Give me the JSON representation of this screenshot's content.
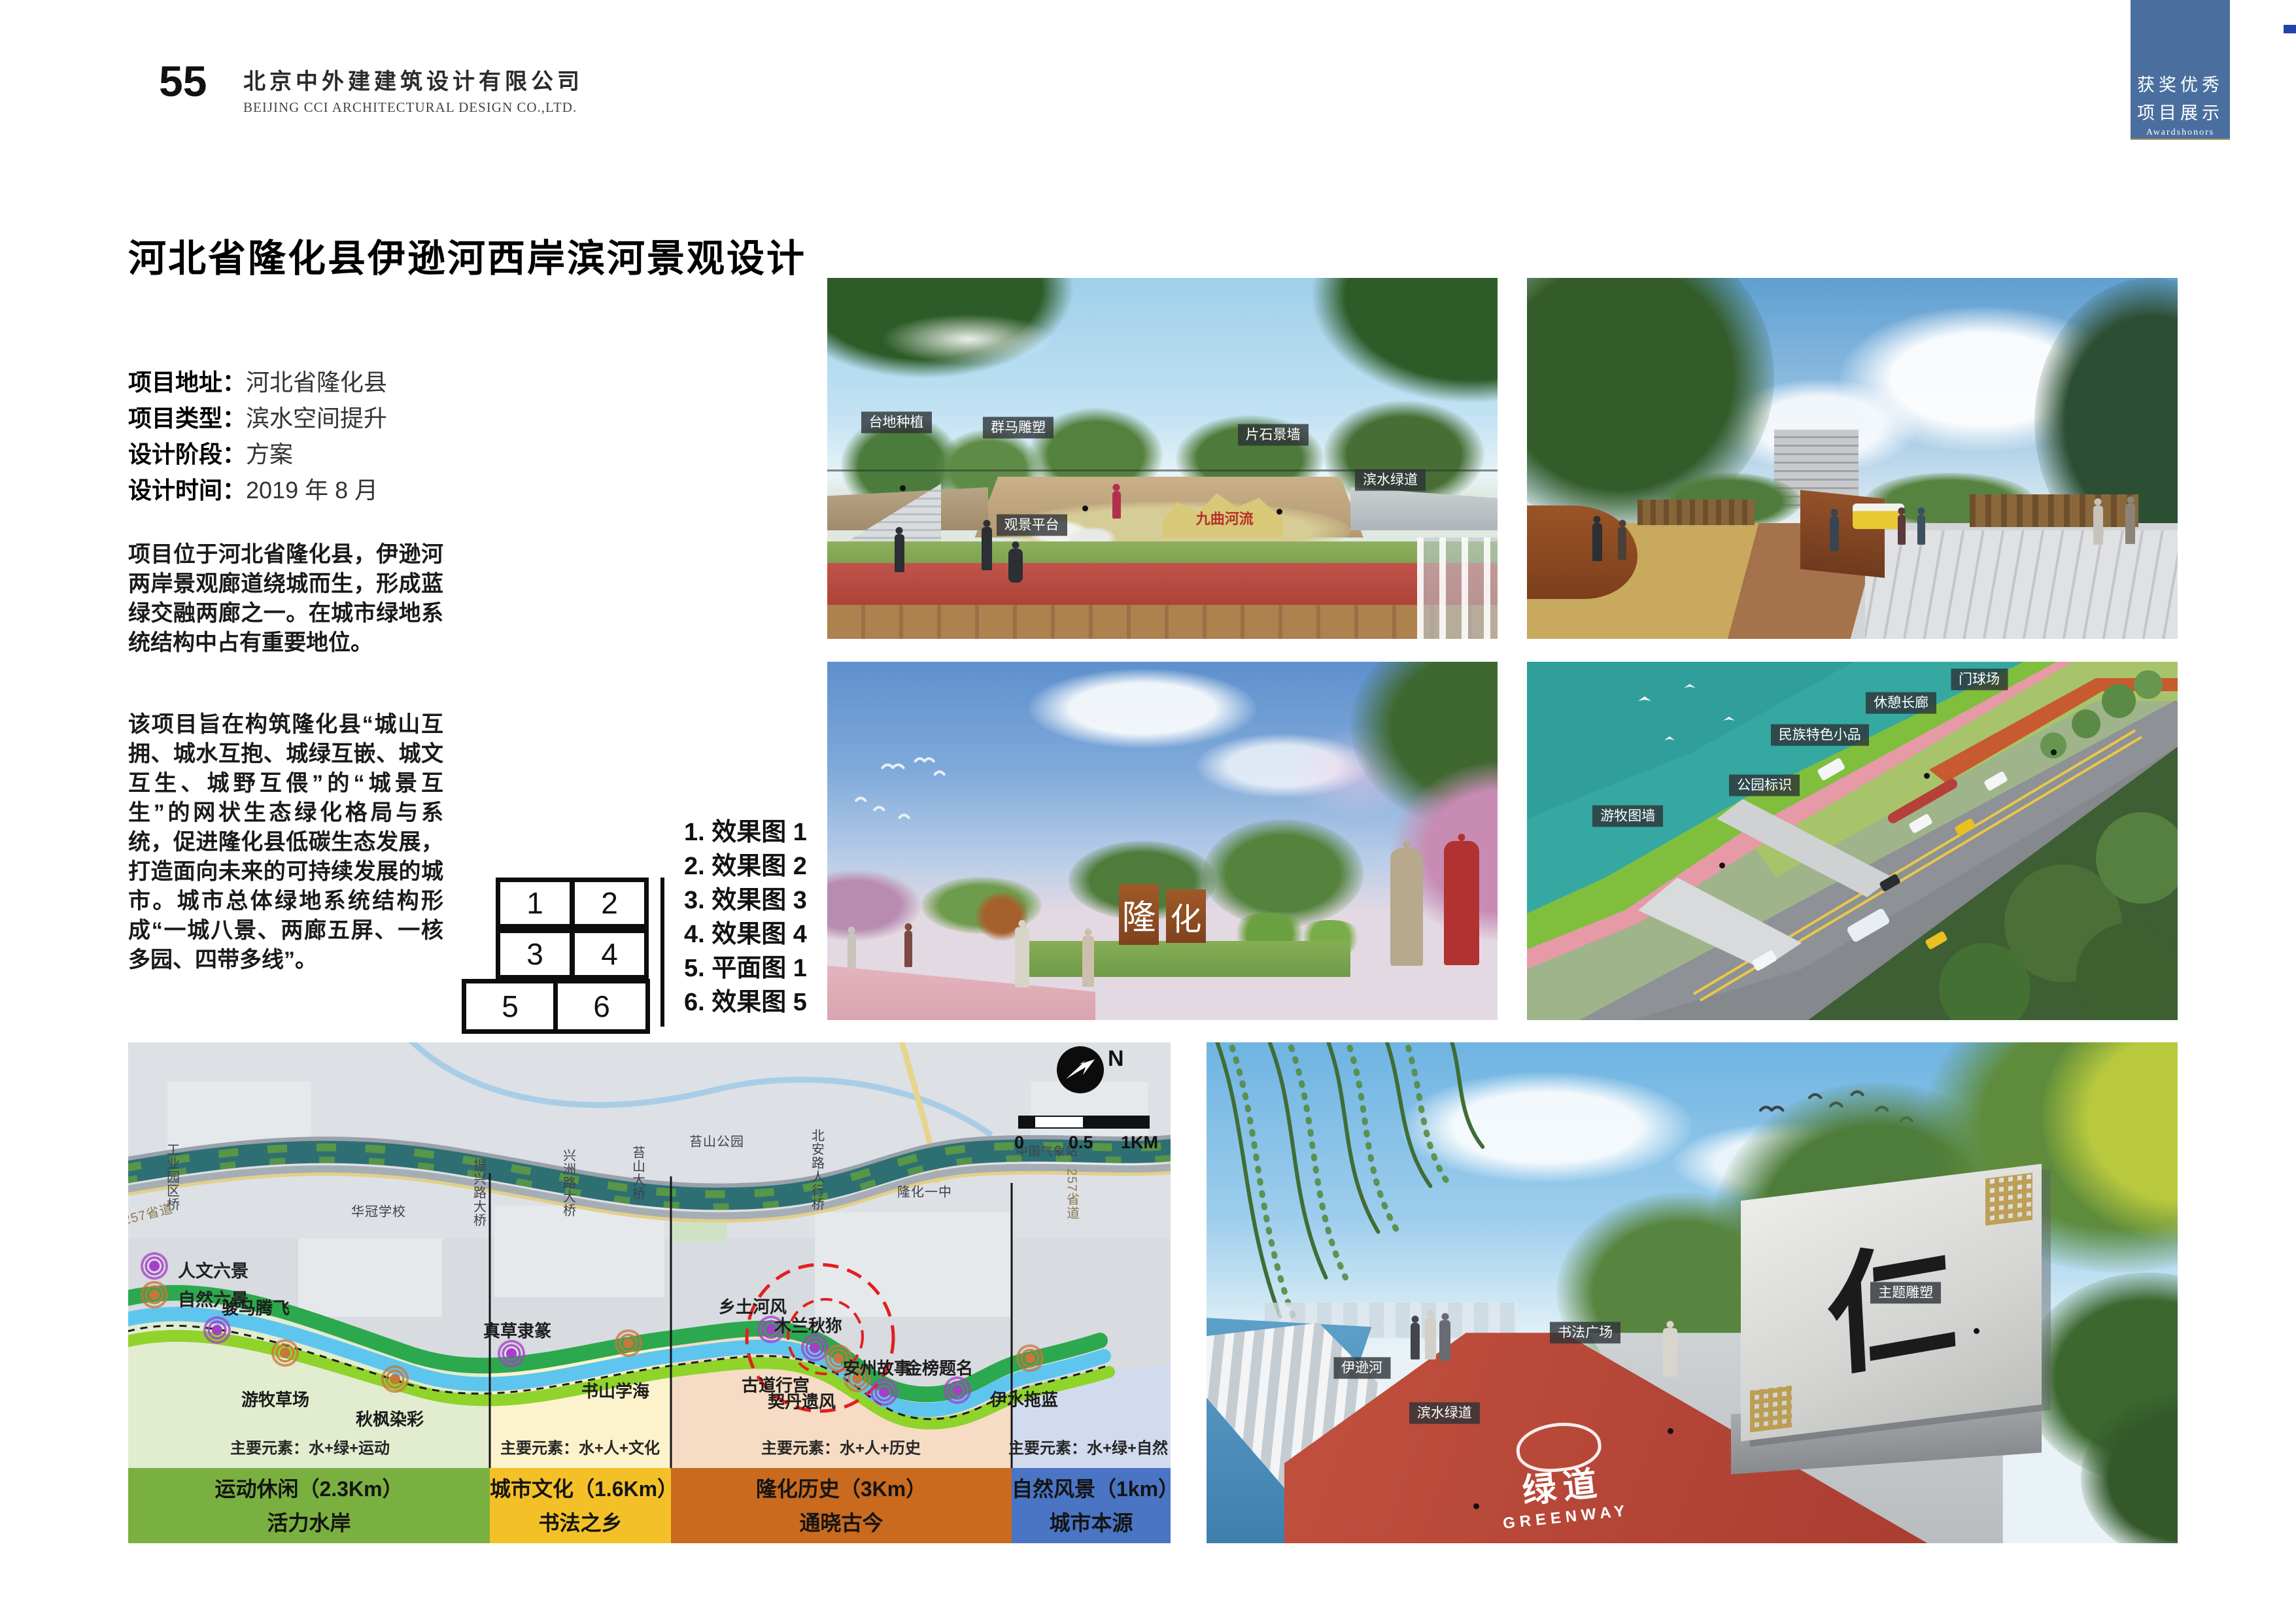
{
  "page_number": "55",
  "header": {
    "company_cn": "北京中外建建筑设计有限公司",
    "company_en": "BEIJING CCI ARCHITECTURAL DESIGN CO.,LTD."
  },
  "corner_tab": {
    "line1": "获奖优秀",
    "line2": "项目展示",
    "line3": "Awardshonors",
    "color": "#4a6f9f"
  },
  "title": "河北省隆化县伊逊河西岸滨河景观设计",
  "project_info": {
    "rows": [
      {
        "label": "项目地址：",
        "value": "河北省隆化县"
      },
      {
        "label": "项目类型：",
        "value": "滨水空间提升"
      },
      {
        "label": "设计阶段：",
        "value": "方案"
      },
      {
        "label": "设计时间：",
        "value": "2019 年 8 月"
      }
    ]
  },
  "paragraphs": {
    "p1": "项目位于河北省隆化县，伊逊河两岸景观廊道绕城而生，形成蓝绿交融两廊之一。在城市绿地系统结构中占有重要地位。",
    "p2": "该项目旨在构筑隆化县“城山互拥、城水互抱、城绿互嵌、城文互生、城野互偎”的“城景互生”的网状生态绿化格局与系统，促进隆化县低碳生态发展，打造面向未来的可持续发展的城市。城市总体绿地系统结构形成“一城八景、两廊五屏、一核多园、四带多线”。"
  },
  "figure_index": {
    "boxes": [
      "1",
      "2",
      "3",
      "4",
      "5",
      "6"
    ],
    "items": [
      "1. 效果图 1",
      "2. 效果图 2",
      "3. 效果图 3",
      "4. 效果图 4",
      "5. 平面图 1",
      "6. 效果图 5"
    ]
  },
  "renderings": {
    "effect1": {
      "labels": {
        "taidi": "台地种植",
        "qunma": "群马雕塑",
        "pianshi": "片石景墙",
        "guanjing": "观景平台",
        "binshui": "滨水绿道"
      },
      "stone_text": "九曲河流"
    },
    "effect3": {
      "sign_left": "隆",
      "sign_right": "化"
    },
    "effect4": {
      "labels": {
        "menqiu": "门球场",
        "xiuqi": "休憩长廊",
        "minzu": "民族特色小品",
        "gongyuan": "公园标识",
        "youmu": "游牧图墙"
      }
    },
    "effect5": {
      "labels": {
        "zhuti": "主题雕塑",
        "shufa": "书法广场",
        "yixunhe": "伊逊河",
        "binshui": "滨水绿道"
      },
      "monument_char": "仁",
      "ground_cn": "绿道",
      "ground_en": "GREENWAY"
    }
  },
  "map": {
    "legend": [
      {
        "label": "人文六景"
      },
      {
        "label": "自然六景"
      }
    ],
    "north": "N",
    "scale_ticks": [
      "0",
      "0.5",
      "1KM"
    ],
    "places": {
      "gongye": "工业园区桥",
      "sheng257_w": "257省道",
      "huaguan": "华冠学校",
      "zhenxing": "振兴路大桥",
      "xingzhou": "兴洲路大桥",
      "taishan_bridge": "苔山大桥",
      "taishan_park": "苔山公园",
      "beian": "北安路人行桥",
      "longhua_yizhong": "隆化一中",
      "qixiangzhan": "中国气象站",
      "sheng257_e": "257省道"
    },
    "pois": {
      "junma": "骏马腾飞",
      "youmu": "游牧草场",
      "qiufeng": "秋枫染彩",
      "zhencao": "真草隶篆",
      "shushan": "书山学海",
      "xiangtu": "乡土河风",
      "mulan": "木兰秋狝",
      "gudao": "古道行宫",
      "qidan": "契丹遗风",
      "anzhou": "安州故事",
      "jinbang": "金榜题名",
      "yishui": "伊水拖蓝"
    },
    "sections": [
      {
        "elements": "主要元素：水+绿+运动",
        "line1": "运动休闲（2.3Km）",
        "line2": "活力水岸",
        "band_color": "#7ab03f",
        "zone_color": "#e2eccf"
      },
      {
        "elements": "主要元素：水+人+文化",
        "line1": "城市文化（1.6Km）",
        "line2": "书法之乡",
        "band_color": "#f3c127",
        "zone_color": "#fcf2cb"
      },
      {
        "elements": "主要元素：水+人+历史",
        "line1": "隆化历史（3Km）",
        "line2": "通晓古今",
        "band_color": "#c96a1e",
        "zone_color": "#f6dcc5"
      },
      {
        "elements": "主要元素：水+绿+自然",
        "line1": "自然风景（1km）",
        "line2": "城市本源",
        "band_color": "#4a74c4",
        "zone_color": "#d2dbee"
      }
    ],
    "colors": {
      "river": "#2e6f74",
      "ribbon_green": "#2ca84e",
      "ribbon_blue": "#5ec6ee",
      "ribbon_lightgreen": "#8fd32b"
    }
  }
}
